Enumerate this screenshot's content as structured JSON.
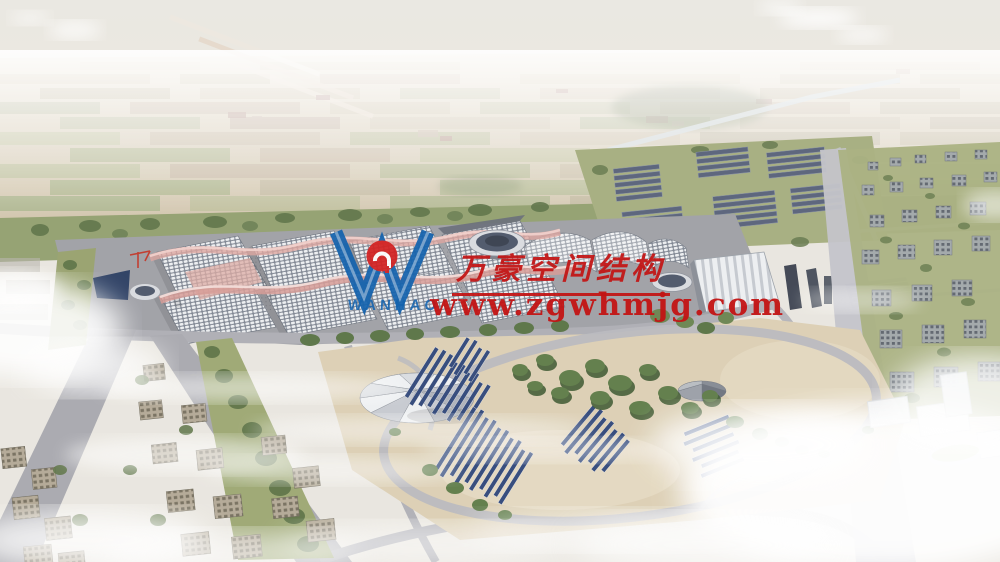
{
  "watermark": {
    "company_name": "万豪空间结构",
    "website": "www.zgwhmjg.com",
    "logo_text": "WANHAO",
    "red": "#c31414",
    "blue": "#1463ae",
    "emblem_red": "#d32222"
  }
}
